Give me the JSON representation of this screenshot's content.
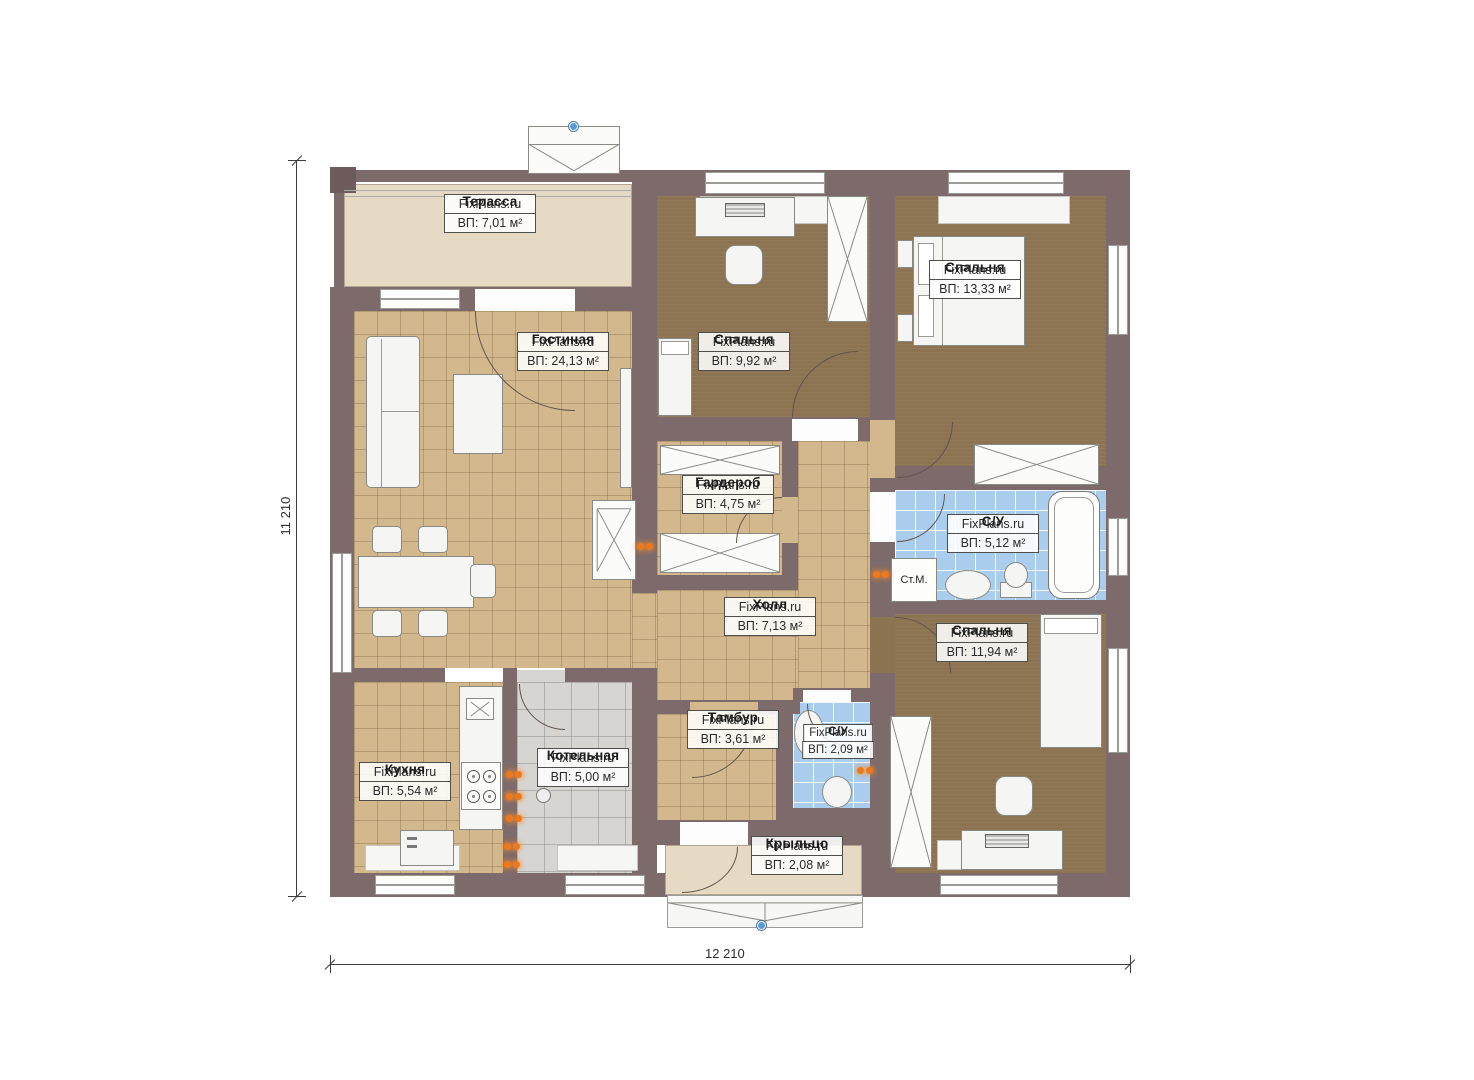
{
  "plan": {
    "watermark": "FixPlans.ru",
    "dimensions": {
      "height_label": "11 210",
      "width_label": "12 210"
    },
    "rooms": {
      "terrace": {
        "name": "Терасса",
        "area": "ВП: 7,01 м²"
      },
      "living": {
        "name": "Гостиная",
        "area": "ВП: 24,13 м²"
      },
      "bedroom1": {
        "name": "Спальня",
        "area": "ВП: 9,92 м²"
      },
      "bedroom2": {
        "name": "Спальня",
        "area": "ВП: 13,33 м²"
      },
      "wardrobe": {
        "name": "Гардероб",
        "area": "ВП: 4,75 м²"
      },
      "bathroom1": {
        "name": "С/У",
        "area": "ВП: 5,12 м²"
      },
      "hall": {
        "name": "Холл",
        "area": "ВП: 7,13 м²"
      },
      "bedroom3": {
        "name": "Спальня",
        "area": "ВП: 11,94 м²"
      },
      "kitchen": {
        "name": "Кухня",
        "area": "ВП: 5,54 м²"
      },
      "boiler": {
        "name": "Котельная",
        "area": "ВП: 5,00 м²"
      },
      "vestibule": {
        "name": "Тамбур",
        "area": "ВП: 3,61 м²"
      },
      "bathroom2": {
        "name": "С/У",
        "area": "ВП: 2,09 м²"
      },
      "porch": {
        "name": "Крыльцо",
        "area": "ВП: 2,08 м²"
      }
    },
    "labels": {
      "washing_machine": "Ст.М."
    },
    "colors": {
      "wall": "#7d6b6b",
      "floor_tile_tan": "#d2b88c",
      "floor_carpet_brown": "#8c7453",
      "floor_tile_blue": "#aacdee",
      "floor_tile_gray": "#d6d5d2",
      "terrace_beige": "#e7dac5",
      "socket_orange": "#f07818",
      "marker_blue": "#5b9bd5"
    }
  }
}
